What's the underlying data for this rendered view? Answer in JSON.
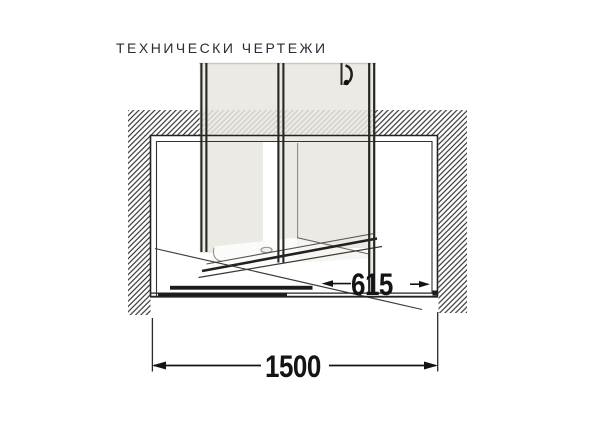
{
  "section": {
    "title": "ТЕХНИЧЕСКИ ЧЕРТЕЖИ"
  },
  "drawing": {
    "type": "shower-enclosure-front-section",
    "dimensions": [
      {
        "id": "overall-width",
        "value": "1500"
      },
      {
        "id": "door-panel-width",
        "value": "615"
      }
    ]
  },
  "colors": {
    "background": "#ffffff",
    "line": "#222222",
    "hatch": "#333333",
    "glass": "#e9e6e1",
    "title_text": "#2c2c35",
    "dimension_text": "#141414"
  }
}
